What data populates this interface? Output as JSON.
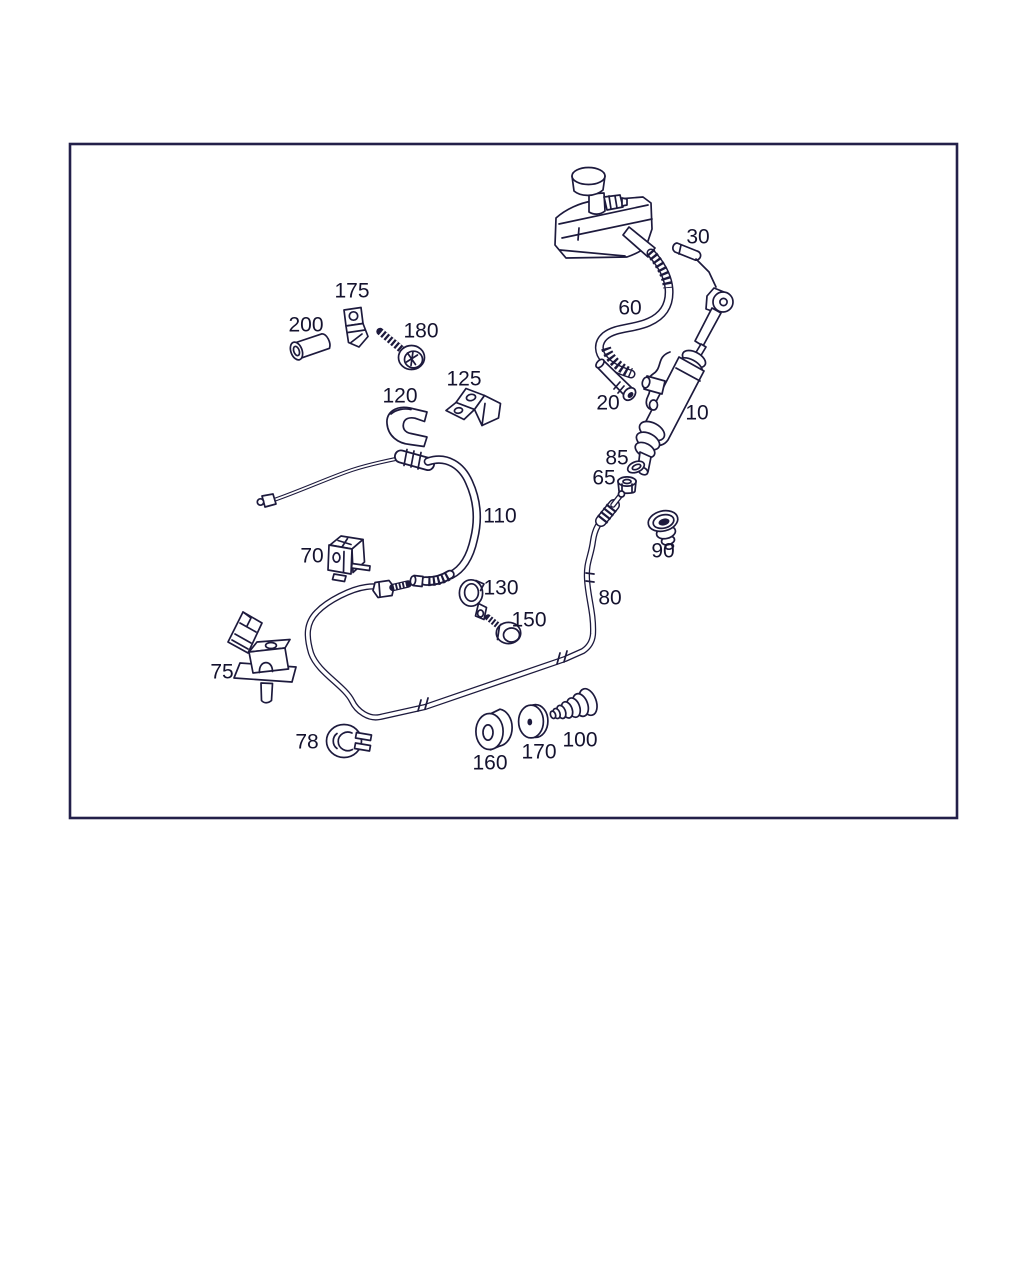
{
  "page": {
    "background": "#ffffff"
  },
  "diagram": {
    "type": "exploded-parts-diagram",
    "description": "Line-art exploded view of a hydraulic clutch system: fluid reservoir, master cylinder, hoses, pipes, clips and grommets with numbered callouts",
    "border_color": "#23204a",
    "line_color": "#1d1a3d",
    "label_color": "#14122e",
    "label_font_size": 21,
    "frame": {
      "x": 70,
      "y": 144,
      "width": 887,
      "height": 674
    },
    "part_labels": [
      {
        "text": "200",
        "x": 306,
        "y": 325
      },
      {
        "text": "175",
        "x": 352,
        "y": 291
      },
      {
        "text": "180",
        "x": 421,
        "y": 331
      },
      {
        "text": "125",
        "x": 464,
        "y": 379
      },
      {
        "text": "120",
        "x": 400,
        "y": 396
      },
      {
        "text": "30",
        "x": 698,
        "y": 237
      },
      {
        "text": "60",
        "x": 630,
        "y": 308
      },
      {
        "text": "20",
        "x": 608,
        "y": 403
      },
      {
        "text": "10",
        "x": 697,
        "y": 413
      },
      {
        "text": "85",
        "x": 617,
        "y": 458
      },
      {
        "text": "65",
        "x": 604,
        "y": 478
      },
      {
        "text": "110",
        "x": 500,
        "y": 516
      },
      {
        "text": "90",
        "x": 663,
        "y": 551
      },
      {
        "text": "70",
        "x": 312,
        "y": 556
      },
      {
        "text": "130",
        "x": 501,
        "y": 588
      },
      {
        "text": "80",
        "x": 610,
        "y": 598
      },
      {
        "text": "150",
        "x": 529,
        "y": 620
      },
      {
        "text": "75",
        "x": 222,
        "y": 672
      },
      {
        "text": "78",
        "x": 307,
        "y": 742
      },
      {
        "text": "160",
        "x": 490,
        "y": 763
      },
      {
        "text": "170",
        "x": 539,
        "y": 752
      },
      {
        "text": "100",
        "x": 580,
        "y": 740
      }
    ],
    "components": [
      {
        "label": "",
        "name": "fluid-reservoir"
      },
      {
        "label": "10",
        "name": "master-cylinder"
      },
      {
        "label": "20",
        "name": "short-tube"
      },
      {
        "label": "30",
        "name": "pin-bolt"
      },
      {
        "label": "60",
        "name": "corrugated-supply-hose"
      },
      {
        "label": "65",
        "name": "hex-nut"
      },
      {
        "label": "70",
        "name": "holder-clip"
      },
      {
        "label": "75",
        "name": "mounting-bracket"
      },
      {
        "label": "78",
        "name": "retaining-clip"
      },
      {
        "label": "80",
        "name": "hydraulic-pipe"
      },
      {
        "label": "85",
        "name": "seal-ring"
      },
      {
        "label": "90",
        "name": "grommet-plug"
      },
      {
        "label": "100",
        "name": "rubber-boot"
      },
      {
        "label": "110",
        "name": "flexible-hose"
      },
      {
        "label": "120",
        "name": "profile-clip"
      },
      {
        "label": "125",
        "name": "holder-bracket"
      },
      {
        "label": "130",
        "name": "p-clamp"
      },
      {
        "label": "150",
        "name": "screw"
      },
      {
        "label": "160",
        "name": "grommet"
      },
      {
        "label": "170",
        "name": "washer-disc"
      },
      {
        "label": "175",
        "name": "clip-plate"
      },
      {
        "label": "180",
        "name": "torx-screw"
      },
      {
        "label": "200",
        "name": "spacer-sleeve"
      }
    ]
  }
}
